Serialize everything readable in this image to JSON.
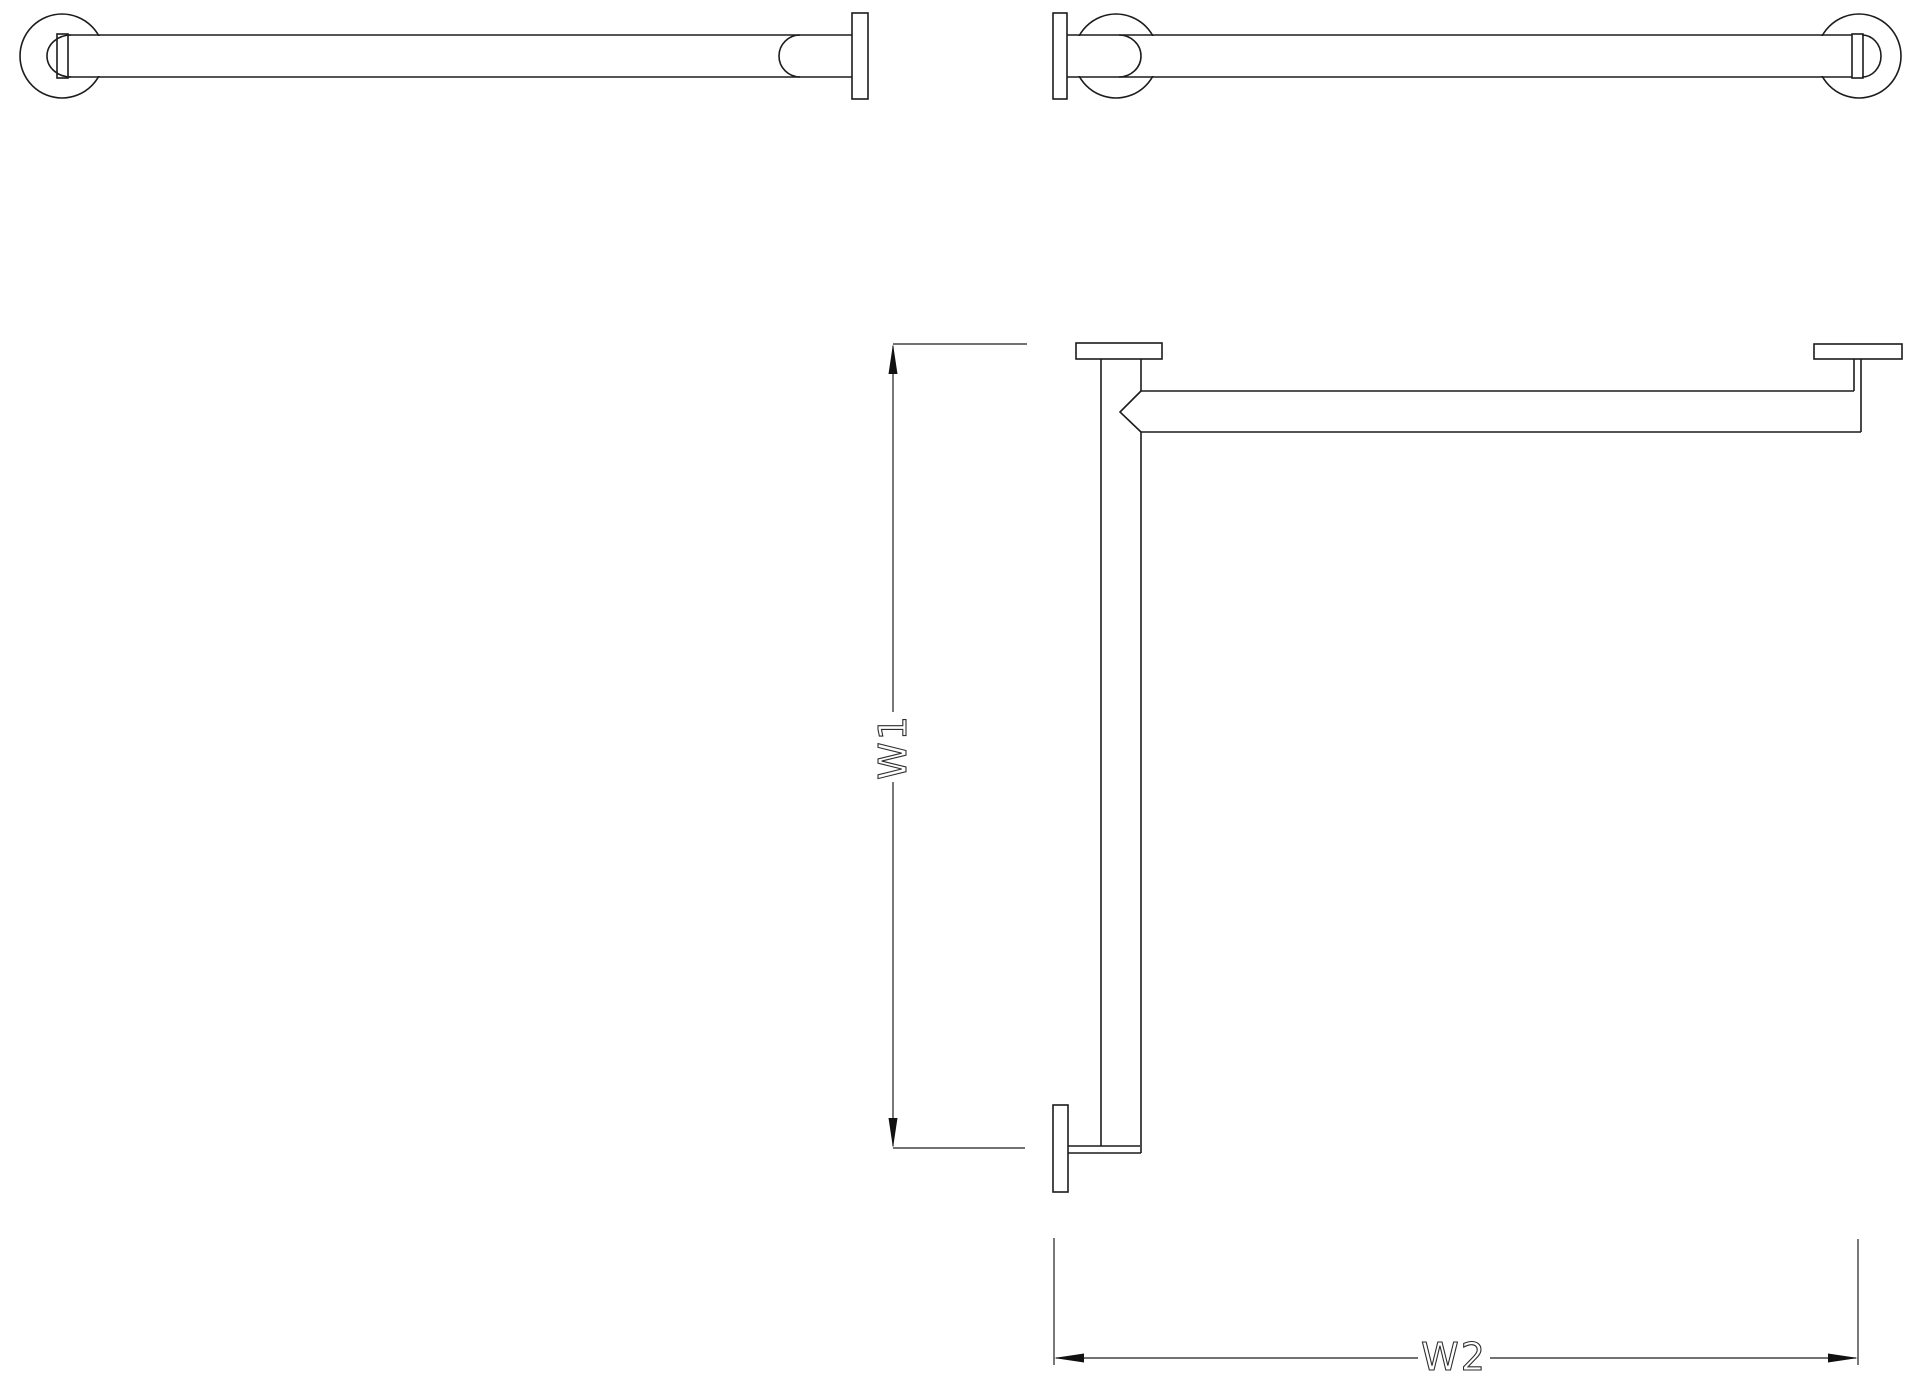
{
  "drawing": {
    "type": "CAD technical drawing",
    "subject": "corner grab bar with wall flanges",
    "background_color": "#ffffff",
    "line_color": "#1c1c1c"
  },
  "views": {
    "elevation_leg1": {
      "description": "elevation of leg 1: round wall flange left, corner flange plate right"
    },
    "elevation_leg2": {
      "description": "elevation of leg 2: corner flange plate left, round wall flange right"
    },
    "plan": {
      "description": "plan view of L-shaped bar with three wall flange plates"
    }
  },
  "dimensions": {
    "w1": {
      "label": "W1",
      "orientation": "vertical"
    },
    "w2": {
      "label": "W2",
      "orientation": "horizontal"
    }
  }
}
